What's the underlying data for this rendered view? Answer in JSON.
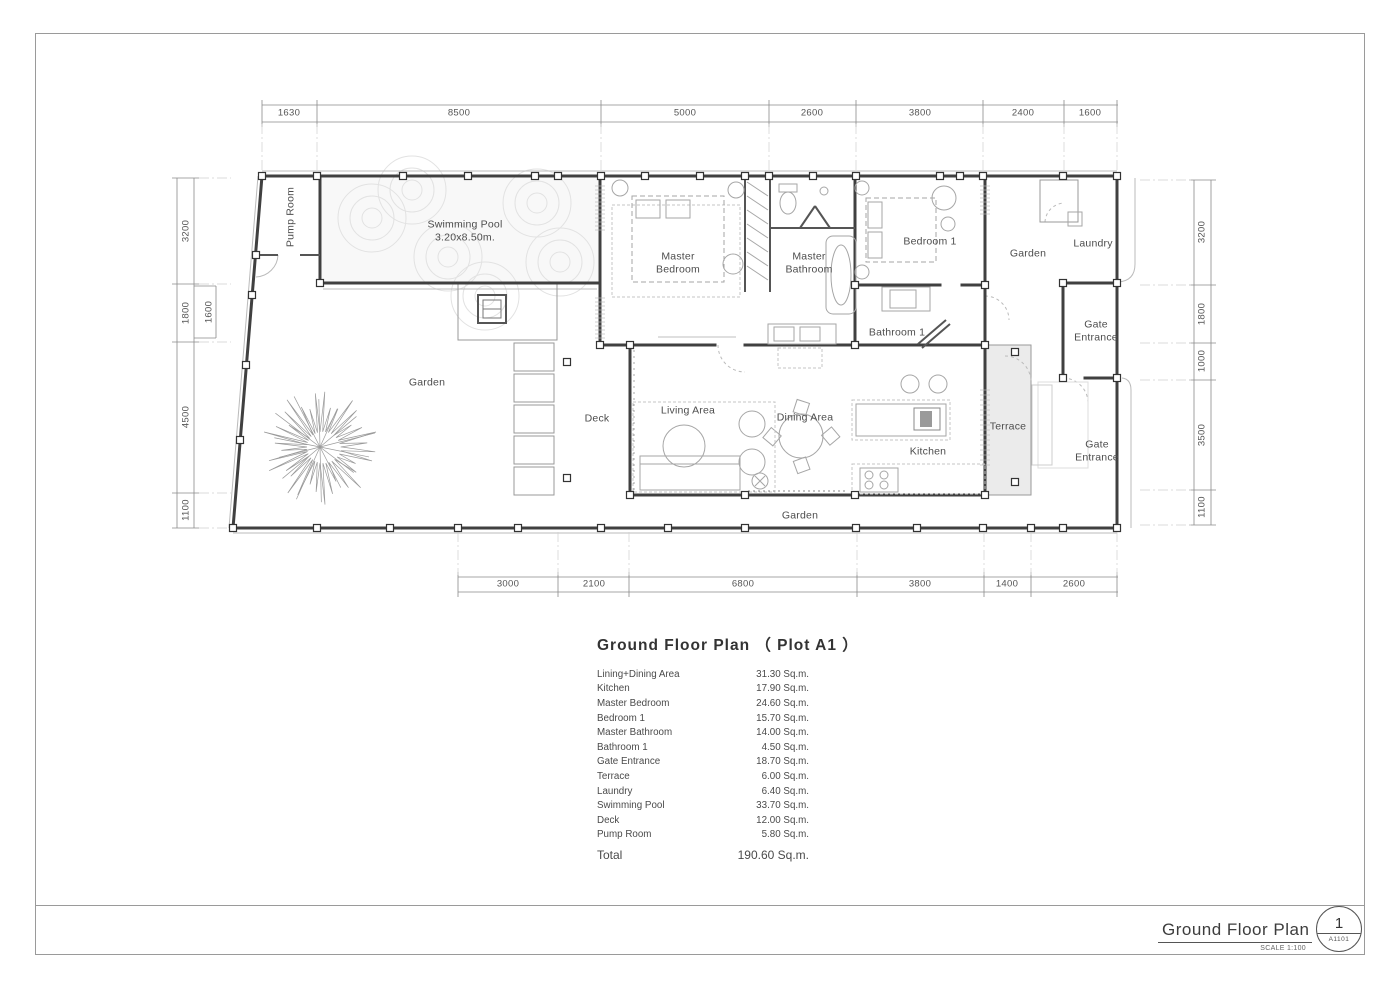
{
  "plan_labels": {
    "pump_room": "Pump Room",
    "swimming_pool": "Swimming Pool\n3.20x8.50m.",
    "master_bedroom": "Master\nBedroom",
    "master_bathroom": "Master\nBathroom",
    "bedroom_1": "Bedroom 1",
    "bathroom_1": "Bathroom 1",
    "garden_upper_right": "Garden",
    "laundry": "Laundry",
    "gate_entrance_upper": "Gate\nEntrance",
    "gate_entrance_lower": "Gate\nEntrance",
    "garden_left": "Garden",
    "garden_bottom": "Garden",
    "deck": "Deck",
    "living_area": "Living Area",
    "dining_area": "Dining Area",
    "kitchen": "Kitchen",
    "terrace": "Terrace"
  },
  "dimensions": {
    "top": [
      "1630",
      "8500",
      "5000",
      "2600",
      "3800",
      "2400",
      "1600"
    ],
    "bottom": [
      "3000",
      "2100",
      "6800",
      "3800",
      "1400",
      "2600"
    ],
    "left": [
      "3200",
      "1800",
      "1600",
      "4500",
      "1100"
    ],
    "right": [
      "3200",
      "1800",
      "1000",
      "3500",
      "1100"
    ]
  },
  "area_table": {
    "title": "Ground Floor Plan （ Plot A1 ）",
    "rows": [
      {
        "name": "Lining+Dining Area",
        "value": "31.30 Sq.m."
      },
      {
        "name": "Kitchen",
        "value": "17.90 Sq.m."
      },
      {
        "name": "Master Bedroom",
        "value": "24.60 Sq.m."
      },
      {
        "name": "Bedroom 1",
        "value": "15.70 Sq.m."
      },
      {
        "name": "Master Bathroom",
        "value": "14.00 Sq.m."
      },
      {
        "name": "Bathroom 1",
        "value": "4.50 Sq.m."
      },
      {
        "name": "Gate Entrance",
        "value": "18.70 Sq.m."
      },
      {
        "name": "Terrace",
        "value": "6.00 Sq.m."
      },
      {
        "name": "Laundry",
        "value": "6.40 Sq.m."
      },
      {
        "name": "Swimming Pool",
        "value": "33.70 Sq.m."
      },
      {
        "name": "Deck",
        "value": "12.00 Sq.m."
      },
      {
        "name": "Pump Room",
        "value": "5.80 Sq.m."
      }
    ],
    "total_label": "Total",
    "total_value": "190.60 Sq.m."
  },
  "title_block": {
    "title": "Ground Floor Plan",
    "scale": "SCALE 1:100",
    "detail_number": "1",
    "sheet_number": "A1101"
  }
}
